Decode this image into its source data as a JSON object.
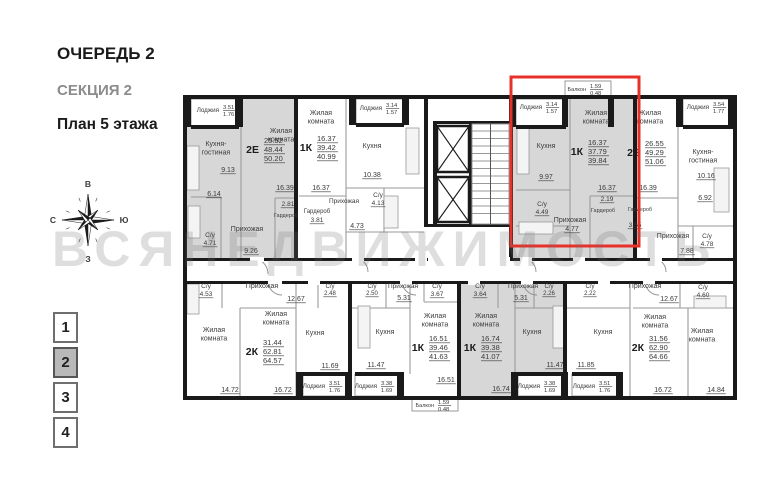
{
  "header": {
    "line1": "ОЧЕРЕДЬ 2",
    "line2": "СЕКЦИЯ 2",
    "line3": "План 5 этажа"
  },
  "compass": {
    "top": "В",
    "right": "Ю",
    "bottom": "З",
    "left": "С"
  },
  "watermark": "ВСЯНЕДВИЖИМОСТЬ",
  "floor_selector": [
    {
      "label": "1",
      "cls": "fsel"
    },
    {
      "label": "2",
      "cls": "fsel active"
    },
    {
      "label": "3",
      "cls": "fsel"
    },
    {
      "label": "4",
      "cls": "fsel"
    }
  ],
  "colors": {
    "wall": "#1a1a1a",
    "thin": "#9a9a9a",
    "gray_fill": "#d7d7d7",
    "text": "#3a3a3a",
    "highlight": "#e8302a"
  },
  "plan": {
    "fills": [
      [
        184,
        97,
        110,
        161
      ],
      [
        513,
        97,
        120,
        161
      ],
      [
        461,
        284,
        102,
        112
      ]
    ],
    "boxes": [
      [
        191,
        99,
        48,
        27
      ],
      [
        356,
        99,
        48,
        26
      ],
      [
        516,
        99,
        50,
        27
      ],
      [
        683,
        99,
        50,
        27
      ],
      [
        565,
        81,
        46,
        16
      ],
      [
        303,
        374,
        44,
        22
      ],
      [
        355,
        374,
        44,
        22
      ],
      [
        518,
        374,
        45,
        22
      ],
      [
        572,
        374,
        46,
        22
      ],
      [
        412,
        398,
        46,
        13
      ]
    ],
    "lines": [
      [
        241,
        125,
        241,
        258
      ],
      [
        221,
        197,
        221,
        258
      ],
      [
        191,
        197,
        221,
        197
      ],
      [
        275,
        198,
        275,
        258
      ],
      [
        275,
        198,
        294,
        198
      ],
      [
        346,
        99,
        346,
        258
      ],
      [
        346,
        188,
        424,
        188
      ],
      [
        384,
        188,
        384,
        232
      ],
      [
        346,
        232,
        424,
        232
      ],
      [
        299,
        196,
        346,
        196
      ],
      [
        570,
        99,
        570,
        258
      ],
      [
        516,
        190,
        570,
        190
      ],
      [
        516,
        226,
        570,
        226
      ],
      [
        590,
        196,
        633,
        196
      ],
      [
        590,
        196,
        590,
        258
      ],
      [
        678,
        99,
        678,
        258
      ],
      [
        678,
        226,
        733,
        226
      ],
      [
        637,
        198,
        678,
        198
      ],
      [
        693,
        226,
        693,
        258
      ],
      [
        630,
        284,
        630,
        396
      ],
      [
        567,
        308,
        630,
        308
      ],
      [
        633,
        308,
        733,
        308
      ],
      [
        688,
        308,
        688,
        396
      ],
      [
        680,
        284,
        680,
        308
      ],
      [
        240,
        308,
        240,
        396
      ],
      [
        240,
        308,
        296,
        308
      ],
      [
        296,
        284,
        296,
        396
      ],
      [
        222,
        284,
        222,
        308
      ],
      [
        318,
        284,
        318,
        308
      ],
      [
        410,
        284,
        410,
        374
      ],
      [
        352,
        308,
        410,
        308
      ],
      [
        386,
        284,
        386,
        308
      ],
      [
        424,
        284,
        424,
        302
      ],
      [
        424,
        302,
        457,
        302
      ],
      [
        515,
        284,
        515,
        374
      ],
      [
        515,
        308,
        563,
        308
      ],
      [
        498,
        284,
        498,
        308
      ],
      [
        534,
        284,
        534,
        308
      ]
    ],
    "fixtures": [
      [
        187,
        146,
        12,
        44
      ],
      [
        188,
        206,
        12,
        32
      ],
      [
        384,
        196,
        14,
        32
      ],
      [
        406,
        128,
        13,
        46
      ],
      [
        517,
        128,
        12,
        46
      ],
      [
        519,
        222,
        34,
        12
      ],
      [
        714,
        168,
        15,
        44
      ],
      [
        694,
        296,
        32,
        12
      ],
      [
        187,
        284,
        12,
        30
      ],
      [
        358,
        306,
        12,
        42
      ],
      [
        553,
        306,
        12,
        42
      ]
    ],
    "arcs": [
      "M252,258 a16,16 0 0 1 16,16",
      "M354,258 a14,14 0 0 1 14,14",
      "M522,258 a14,14 0 0 1 14,14",
      "M652,258 a14,14 0 0 1 14,14",
      "M282,295 a14,14 0 0 1 -14,-14",
      "M416,295 a14,14 0 0 1 -14,-14",
      "M537,295 a14,14 0 0 1 -14,-14",
      "M659,295 a14,14 0 0 1 -14,-14"
    ],
    "walls": [
      [
        183,
        95,
        554,
        4
      ],
      [
        183,
        396,
        554,
        4
      ],
      [
        183,
        95,
        4,
        305
      ],
      [
        733,
        95,
        4,
        305
      ],
      [
        294,
        99,
        4,
        159
      ],
      [
        424,
        99,
        4,
        128
      ],
      [
        509,
        99,
        4,
        159
      ],
      [
        633,
        99,
        4,
        159
      ],
      [
        183,
        258,
        554,
        3
      ],
      [
        183,
        281,
        554,
        3
      ],
      [
        348,
        284,
        4,
        112
      ],
      [
        457,
        284,
        4,
        112
      ],
      [
        563,
        284,
        4,
        112
      ],
      [
        433,
        121,
        4,
        106
      ],
      [
        469,
        121,
        3,
        106
      ],
      [
        433,
        121,
        77,
        3
      ],
      [
        426,
        224,
        87,
        3
      ],
      [
        183,
        95,
        8,
        32
      ],
      [
        235,
        95,
        8,
        32
      ],
      [
        349,
        95,
        7,
        30
      ],
      [
        402,
        95,
        7,
        30
      ],
      [
        509,
        95,
        7,
        32
      ],
      [
        562,
        95,
        6,
        32
      ],
      [
        608,
        95,
        6,
        32
      ],
      [
        676,
        95,
        7,
        32
      ],
      [
        728,
        95,
        9,
        32
      ],
      [
        191,
        125,
        48,
        4
      ],
      [
        356,
        123,
        48,
        4
      ],
      [
        516,
        125,
        50,
        4
      ],
      [
        683,
        125,
        50,
        4
      ],
      [
        303,
        372,
        44,
        4
      ],
      [
        355,
        372,
        44,
        4
      ],
      [
        518,
        372,
        45,
        4
      ],
      [
        572,
        372,
        46,
        4
      ],
      [
        296,
        372,
        7,
        26
      ],
      [
        345,
        372,
        7,
        26
      ],
      [
        397,
        372,
        7,
        26
      ],
      [
        511,
        372,
        7,
        26
      ],
      [
        561,
        372,
        7,
        26
      ],
      [
        616,
        372,
        7,
        26
      ]
    ],
    "doors": [
      [
        250,
        257,
        14
      ],
      [
        352,
        257,
        12
      ],
      [
        415,
        257,
        12
      ],
      [
        428,
        257,
        82
      ],
      [
        520,
        257,
        12
      ],
      [
        573,
        257,
        12
      ],
      [
        650,
        257,
        12
      ],
      [
        268,
        280,
        14
      ],
      [
        308,
        280,
        12
      ],
      [
        400,
        280,
        12
      ],
      [
        468,
        280,
        12
      ],
      [
        521,
        280,
        12
      ],
      [
        598,
        280,
        12
      ],
      [
        643,
        280,
        12
      ]
    ],
    "elevators": [
      {
        "x": 437,
        "y": 126,
        "w": 32,
        "h": 46
      },
      {
        "x": 437,
        "y": 177,
        "w": 32,
        "h": 45
      }
    ],
    "stairs": {
      "x": 472,
      "y": 124,
      "w": 37,
      "h": 100
    },
    "red_box": {
      "x": 511,
      "y": 77,
      "w": 128,
      "h": 169
    },
    "labels": [
      [
        "Кухня-\nгостиная",
        216,
        146,
        7
      ],
      [
        "9.13",
        228,
        172,
        7,
        1
      ],
      [
        "6.14",
        214,
        196,
        7,
        1
      ],
      [
        "Жилая\nкомната",
        281,
        133,
        7
      ],
      [
        "16.39",
        285,
        190,
        7,
        1
      ],
      [
        "2.81",
        288,
        206,
        6.5,
        1
      ],
      [
        "Гардероб",
        286,
        217,
        5.5
      ],
      [
        "С/у",
        210,
        237,
        6.5
      ],
      [
        "4.71",
        210,
        245,
        6.5,
        1
      ],
      [
        "Прихожая",
        247,
        231,
        7
      ],
      [
        "9.26",
        251,
        253,
        7,
        1
      ],
      [
        "Жилая\nкомната",
        321,
        115,
        7
      ],
      [
        "16.37",
        321,
        190,
        7,
        1
      ],
      [
        "Гардероб",
        317,
        213,
        6
      ],
      [
        "3.81",
        317,
        222,
        6.5,
        1
      ],
      [
        "Прихожая",
        344,
        203,
        6.5
      ],
      [
        "4.73",
        357,
        228,
        7,
        1
      ],
      [
        "Кухня",
        372,
        148,
        7
      ],
      [
        "10.38",
        372,
        177,
        7,
        1
      ],
      [
        "С/у",
        378,
        197,
        6.5
      ],
      [
        "4.13",
        378,
        205,
        6.5,
        1
      ],
      [
        "Кухня",
        546,
        148,
        7
      ],
      [
        "9.97",
        546,
        179,
        7,
        1
      ],
      [
        "Жилая\nкомната",
        596,
        115,
        7
      ],
      [
        "16.37",
        607,
        190,
        7,
        1
      ],
      [
        "2.19",
        607,
        201,
        6.5,
        1
      ],
      [
        "Гардероб",
        603,
        212,
        5.5
      ],
      [
        "С/у",
        542,
        206,
        6.5
      ],
      [
        "4.49",
        542,
        214,
        6.5,
        1
      ],
      [
        "Прихожая",
        570,
        222,
        7
      ],
      [
        "4.77",
        572,
        231,
        7,
        1
      ],
      [
        "Жилая\nкомната",
        650,
        115,
        7
      ],
      [
        "16.39",
        648,
        190,
        7,
        1
      ],
      [
        "Кухня-\nгостиная",
        703,
        154,
        7
      ],
      [
        "10.16",
        706,
        178,
        7,
        1
      ],
      [
        "6.92",
        705,
        200,
        7,
        1
      ],
      [
        "Гардероб",
        640,
        211,
        5.5
      ],
      [
        "3.55",
        635,
        227,
        6.5,
        1
      ],
      [
        "Прихожая",
        673,
        238,
        7
      ],
      [
        "7.88",
        687,
        253,
        7,
        1
      ],
      [
        "С/у",
        707,
        238,
        6.5
      ],
      [
        "4.78",
        707,
        246,
        6.5,
        1
      ],
      [
        "Прихожая",
        645,
        288,
        7
      ],
      [
        "12.67",
        669,
        301,
        7,
        1
      ],
      [
        "С/у",
        703,
        289,
        6.5
      ],
      [
        "4.60",
        703,
        297,
        6.5,
        1
      ],
      [
        "С/у",
        590,
        288,
        6
      ],
      [
        "2.22",
        590,
        295,
        6,
        1
      ],
      [
        "Жилая\nкомната",
        655,
        319,
        7
      ],
      [
        "16.72",
        663,
        392,
        7,
        1
      ],
      [
        "Жилая\nкомната",
        702,
        333,
        7
      ],
      [
        "14.84",
        716,
        392,
        7,
        1
      ],
      [
        "Кухня",
        603,
        334,
        7
      ],
      [
        "11.85",
        586,
        367,
        7,
        1
      ],
      [
        "С/у",
        206,
        288,
        6.5
      ],
      [
        "4.53",
        206,
        296,
        6.5,
        1
      ],
      [
        "Прихожая",
        262,
        288,
        7
      ],
      [
        "12.67",
        296,
        301,
        7,
        1
      ],
      [
        "С/у",
        330,
        288,
        6
      ],
      [
        "2.48",
        330,
        295,
        6,
        1
      ],
      [
        "Жилая\nкомната",
        214,
        332,
        7
      ],
      [
        "Жилая\nкомната",
        276,
        316,
        7
      ],
      [
        "14.72",
        230,
        392,
        7,
        1
      ],
      [
        "16.72",
        283,
        392,
        7,
        1
      ],
      [
        "Кухня",
        315,
        335,
        7
      ],
      [
        "11.69",
        330,
        368,
        7,
        1
      ],
      [
        "С/у",
        372,
        288,
        6
      ],
      [
        "2.50",
        372,
        295,
        6,
        1
      ],
      [
        "Прихожая",
        403,
        288,
        6.5
      ],
      [
        "5.31",
        404,
        300,
        7,
        1
      ],
      [
        "Кухня",
        385,
        334,
        7
      ],
      [
        "11.47",
        376,
        367,
        7,
        1
      ],
      [
        "Жилая\nкомната",
        435,
        318,
        7
      ],
      [
        "16.51",
        446,
        382,
        7,
        1
      ],
      [
        "С/у",
        437,
        288,
        6.5
      ],
      [
        "3.67",
        437,
        296,
        6.5,
        1
      ],
      [
        "С/у",
        480,
        288,
        6.5
      ],
      [
        "3.64",
        480,
        296,
        6.5,
        1
      ],
      [
        "Прихожая",
        523,
        288,
        6.5
      ],
      [
        "5.31",
        521,
        300,
        7,
        1
      ],
      [
        "Жилая\nкомната",
        486,
        318,
        7
      ],
      [
        "16.74",
        501,
        391,
        7,
        1
      ],
      [
        "С/у",
        549,
        288,
        6
      ],
      [
        "2.26",
        549,
        295,
        6,
        1
      ],
      [
        "Кухня",
        532,
        334,
        7
      ],
      [
        "11.47",
        555,
        367,
        7,
        1
      ]
    ],
    "apts": [
      {
        "t": "2Е",
        "x": 259,
        "y": 150,
        "n": [
          "25.52",
          "48.44",
          "50.20"
        ]
      },
      {
        "t": "1К",
        "x": 312,
        "y": 148,
        "n": [
          "16.37",
          "39.42",
          "40.99"
        ]
      },
      {
        "t": "1К",
        "x": 583,
        "y": 152,
        "n": [
          "16.37",
          "37.79",
          "39.84"
        ]
      },
      {
        "t": "2Е",
        "x": 640,
        "y": 153,
        "n": [
          "26.55",
          "49.29",
          "51.06"
        ]
      },
      {
        "t": "2К",
        "x": 258,
        "y": 352,
        "n": [
          "31.44",
          "62.81",
          "64.57"
        ]
      },
      {
        "t": "1К",
        "x": 424,
        "y": 348,
        "n": [
          "16.51",
          "39.46",
          "41.63"
        ]
      },
      {
        "t": "1К",
        "x": 476,
        "y": 348,
        "n": [
          "16.74",
          "39.38",
          "41.07"
        ]
      },
      {
        "t": "2К",
        "x": 644,
        "y": 348,
        "n": [
          "31.56",
          "62.90",
          "64.66"
        ]
      }
    ],
    "lg": [
      {
        "t": "Лоджия",
        "x": 219,
        "y": 110,
        "a": "3.51",
        "b": "1.76"
      },
      {
        "t": "Лоджия",
        "x": 382,
        "y": 108,
        "a": "3.14",
        "b": "1.57"
      },
      {
        "t": "Лоджия",
        "x": 542,
        "y": 107,
        "a": "3.14",
        "b": "1.57"
      },
      {
        "t": "Лоджия",
        "x": 709,
        "y": 107,
        "a": "3.54",
        "b": "1.77"
      },
      {
        "t": "Балкон",
        "x": 586,
        "y": 89,
        "a": "1.59",
        "b": "0.48",
        "s": 5.5
      },
      {
        "t": "Лоджия",
        "x": 325,
        "y": 386,
        "a": "3.51",
        "b": "1.76"
      },
      {
        "t": "Лоджия",
        "x": 377,
        "y": 386,
        "a": "3.38",
        "b": "1.69"
      },
      {
        "t": "Лоджия",
        "x": 540,
        "y": 386,
        "a": "3.38",
        "b": "1.69"
      },
      {
        "t": "Лоджия",
        "x": 595,
        "y": 386,
        "a": "3.51",
        "b": "1.76"
      },
      {
        "t": "Балкон",
        "x": 434,
        "y": 405,
        "a": "1.59",
        "b": "0.48",
        "s": 5.5
      }
    ]
  }
}
